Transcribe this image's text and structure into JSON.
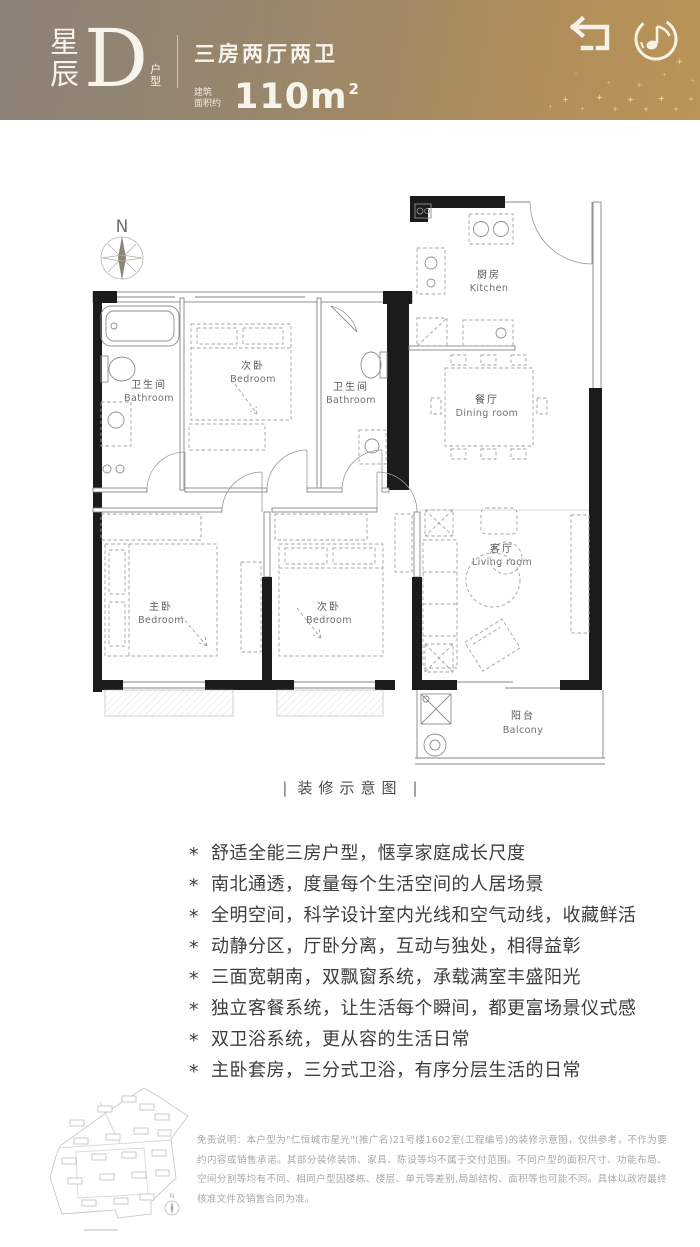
{
  "header": {
    "brand_zh": "星辰",
    "unit_letter": "D",
    "unit_suffix": "户型",
    "layout_spec": "三房两厅两卫",
    "area_prefix_line1": "建筑",
    "area_prefix_line2": "面积约",
    "area_value": "110m",
    "area_superscript": "2",
    "icons": [
      "return-icon",
      "music-disc-icon"
    ]
  },
  "colors": {
    "header_gradient_left": "#8c8177",
    "header_gradient_right": "#bb9456",
    "header_text": "#f7f4ec",
    "wall_black": "#1b1b1b",
    "plan_line_gray": "#858585",
    "feature_text": "#3d3d3d",
    "disclaimer_text": "#a8a8a8"
  },
  "floorplan": {
    "compass_label": "N",
    "caption": "装修示意图",
    "caption_divider": "|",
    "rooms": [
      {
        "zh": "厨房",
        "en": "Kitchen"
      },
      {
        "zh": "餐厅",
        "en": "Dining room"
      },
      {
        "zh": "卫生间",
        "en": "Bathroom"
      },
      {
        "zh": "次卧",
        "en": "Bedroom"
      },
      {
        "zh": "卫生间",
        "en": "Bathroom"
      },
      {
        "zh": "主卧",
        "en": "Bedroom"
      },
      {
        "zh": "次卧",
        "en": "Bedroom"
      },
      {
        "zh": "客厅",
        "en": "Living room"
      },
      {
        "zh": "阳台",
        "en": "Balcony"
      }
    ]
  },
  "features": {
    "marker": "*",
    "items": [
      "舒适全能三房户型，惬享家庭成长尺度",
      "南北通透，度量每个生活空间的人居场景",
      "全明空间，科学设计室内光线和空气动线，收藏鲜活",
      "动静分区，厅卧分离，互动与独处，相得益彰",
      "三面宽朝南，双飘窗系统，承载满室丰盛阳光",
      "独立客餐系统，让生活每个瞬间，都更富场景仪式感",
      "双卫浴系统，更从容的生活日常",
      "主卧套房，三分式卫浴，有序分层生活的日常"
    ]
  },
  "site_plan": {
    "compass": "N"
  },
  "footer": {
    "disclaimer": "免责说明：本户型为\"仁恒城市星光\"(推广名)21号楼1602室(工程编号)的装修示意图，仅供参考，不作为要约内容或销售承诺。其部分装修装饰、家具、陈设等均不属于交付范围。不同户型的面积尺寸、功能布局、空间分割等均有不同、相同户型因楼栋、楼层、单元等差别,局部结构、面积等也可能不同。具体以政府最终核准文件及销售合同为准。"
  }
}
